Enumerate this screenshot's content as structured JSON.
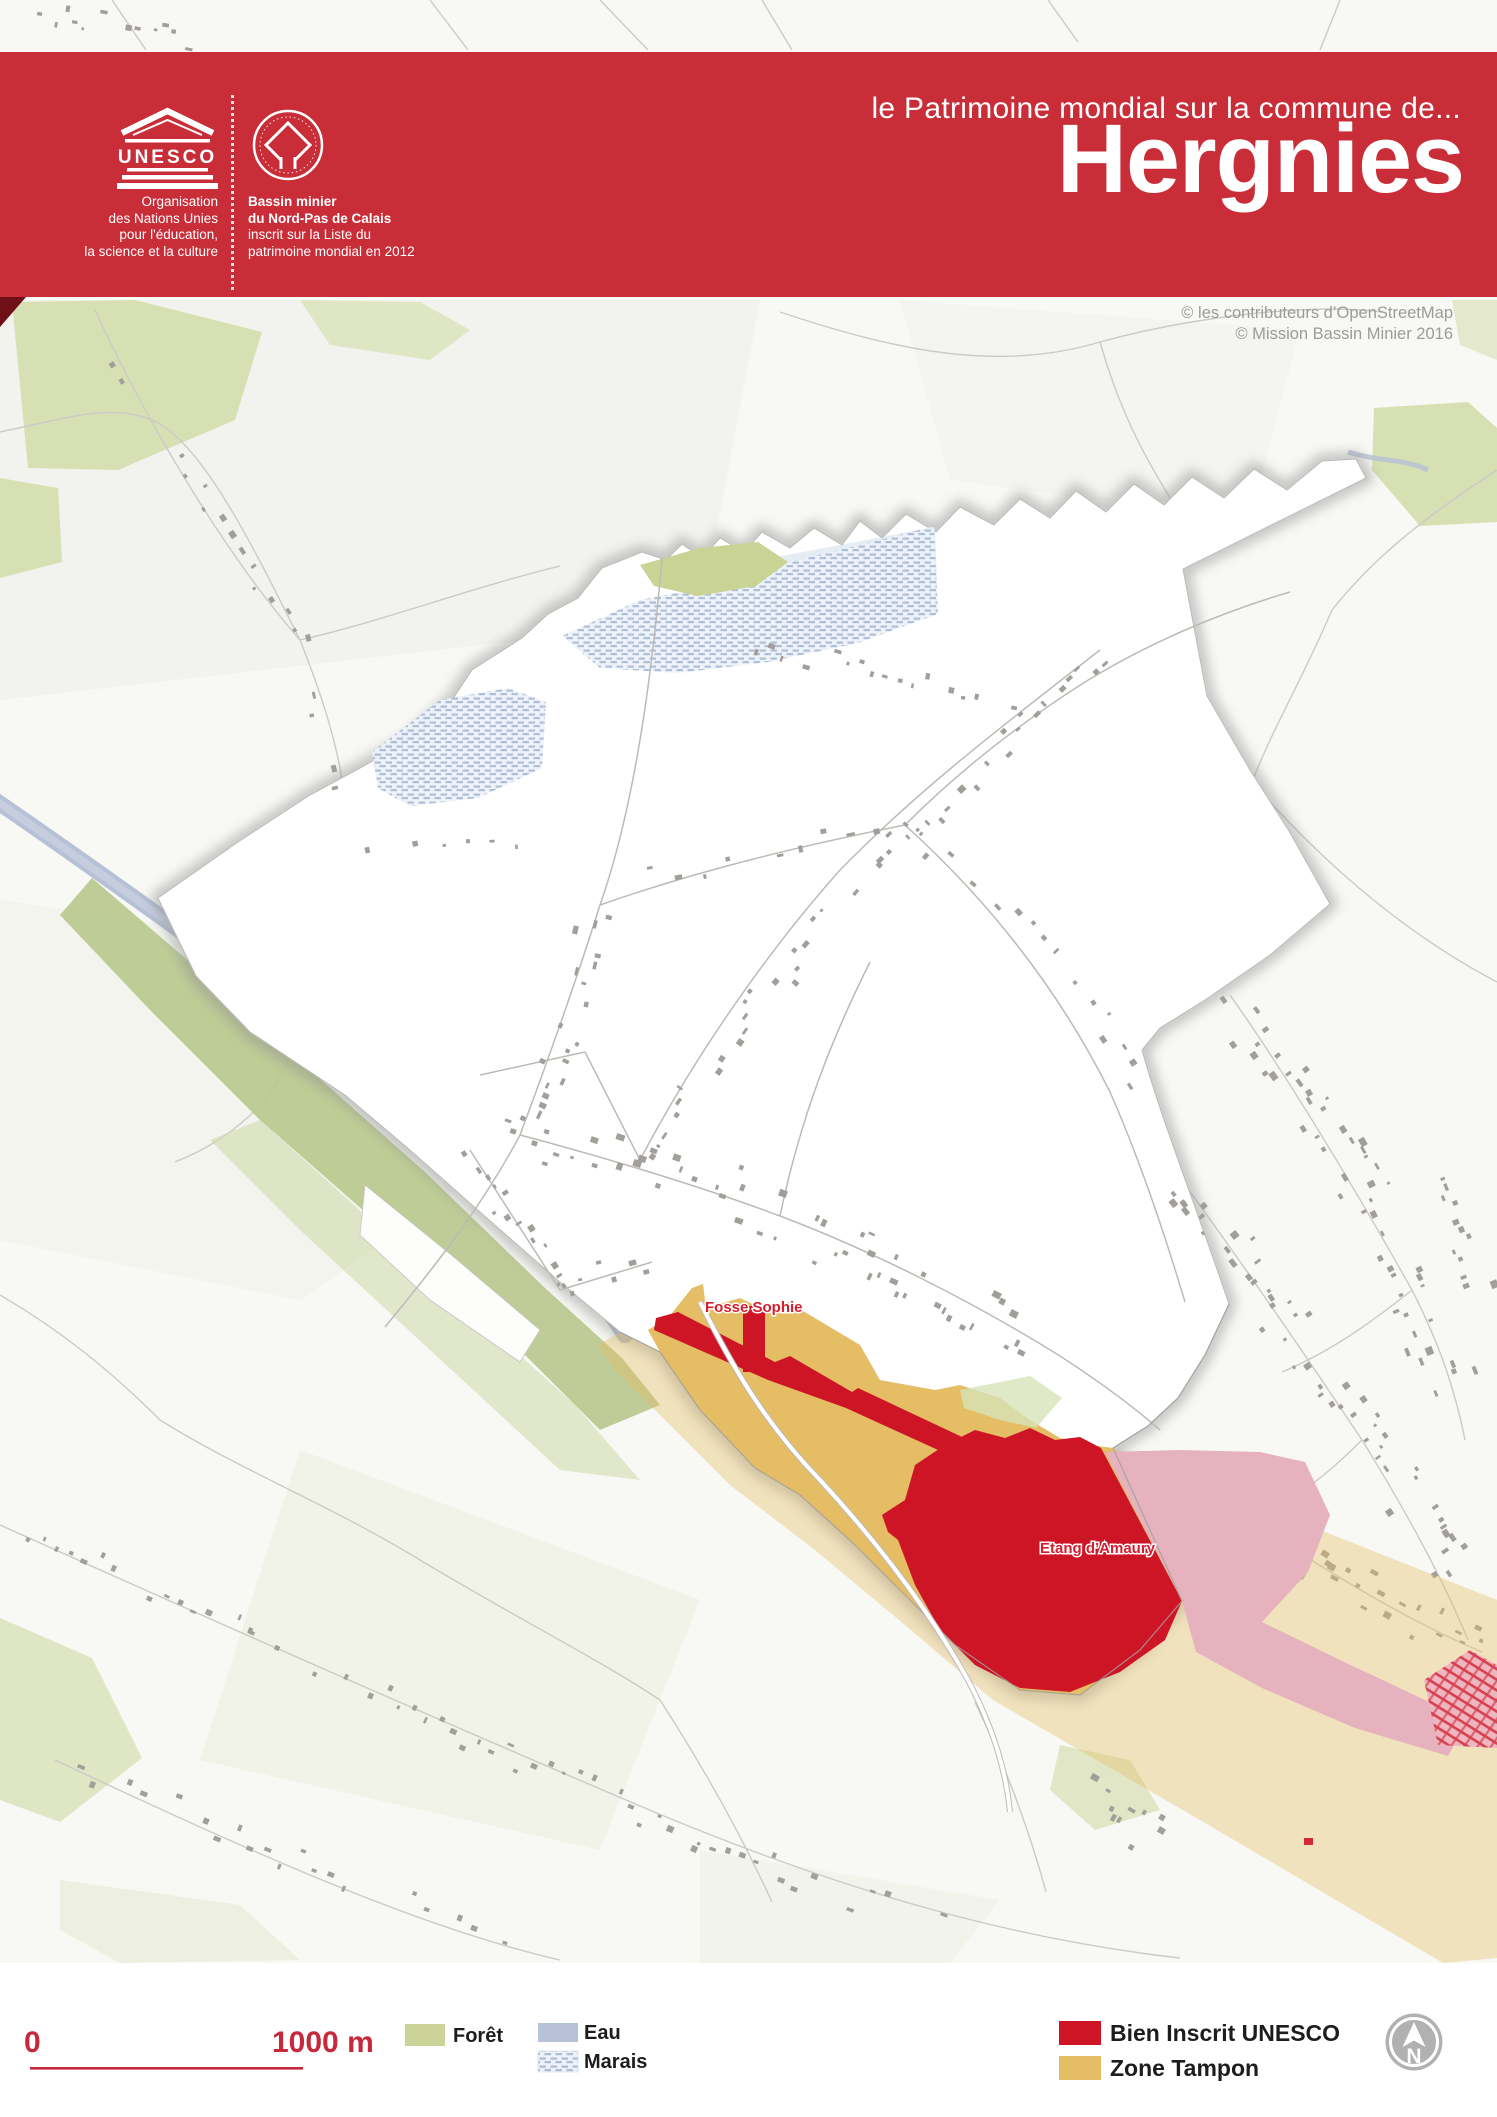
{
  "header": {
    "kicker": "le Patrimoine mondial sur la commune de...",
    "title": "Hergnies",
    "unesco_acronym": "UNESCO",
    "org_line1": "Organisation",
    "org_line2": "des Nations Unies",
    "org_line3": "pour l'éducation,",
    "org_line4": "la science et la culture",
    "emblem_line1": "Bassin minier",
    "emblem_line2": "du Nord-Pas de Calais",
    "emblem_line3": "inscrit sur la Liste du",
    "emblem_line4": "patrimoine mondial en 2012"
  },
  "map": {
    "credit_line1": "© les contributeurs d’OpenStreetMap",
    "credit_line2": "© Mission Bassin Minier 2016",
    "label_fosse_sophie": "Fosse Sophie",
    "label_etang_amaury": "Etang d’Amaury"
  },
  "legend": {
    "scale_start": "0",
    "scale_end": "1000 m",
    "foret": "Forêt",
    "eau": "Eau",
    "marais": "Marais",
    "bien_inscrit": "Bien Inscrit UNESCO",
    "zone_tampon": "Zone Tampon",
    "north": "N"
  },
  "colors": {
    "header_red": "#c92d38",
    "bien_inscrit_red": "#ce1526",
    "zone_tampon_tan": "#e4bd65",
    "foret_green": "#cbd399",
    "eau_blue": "#b7c1d7",
    "scale_red": "#c5293b"
  }
}
